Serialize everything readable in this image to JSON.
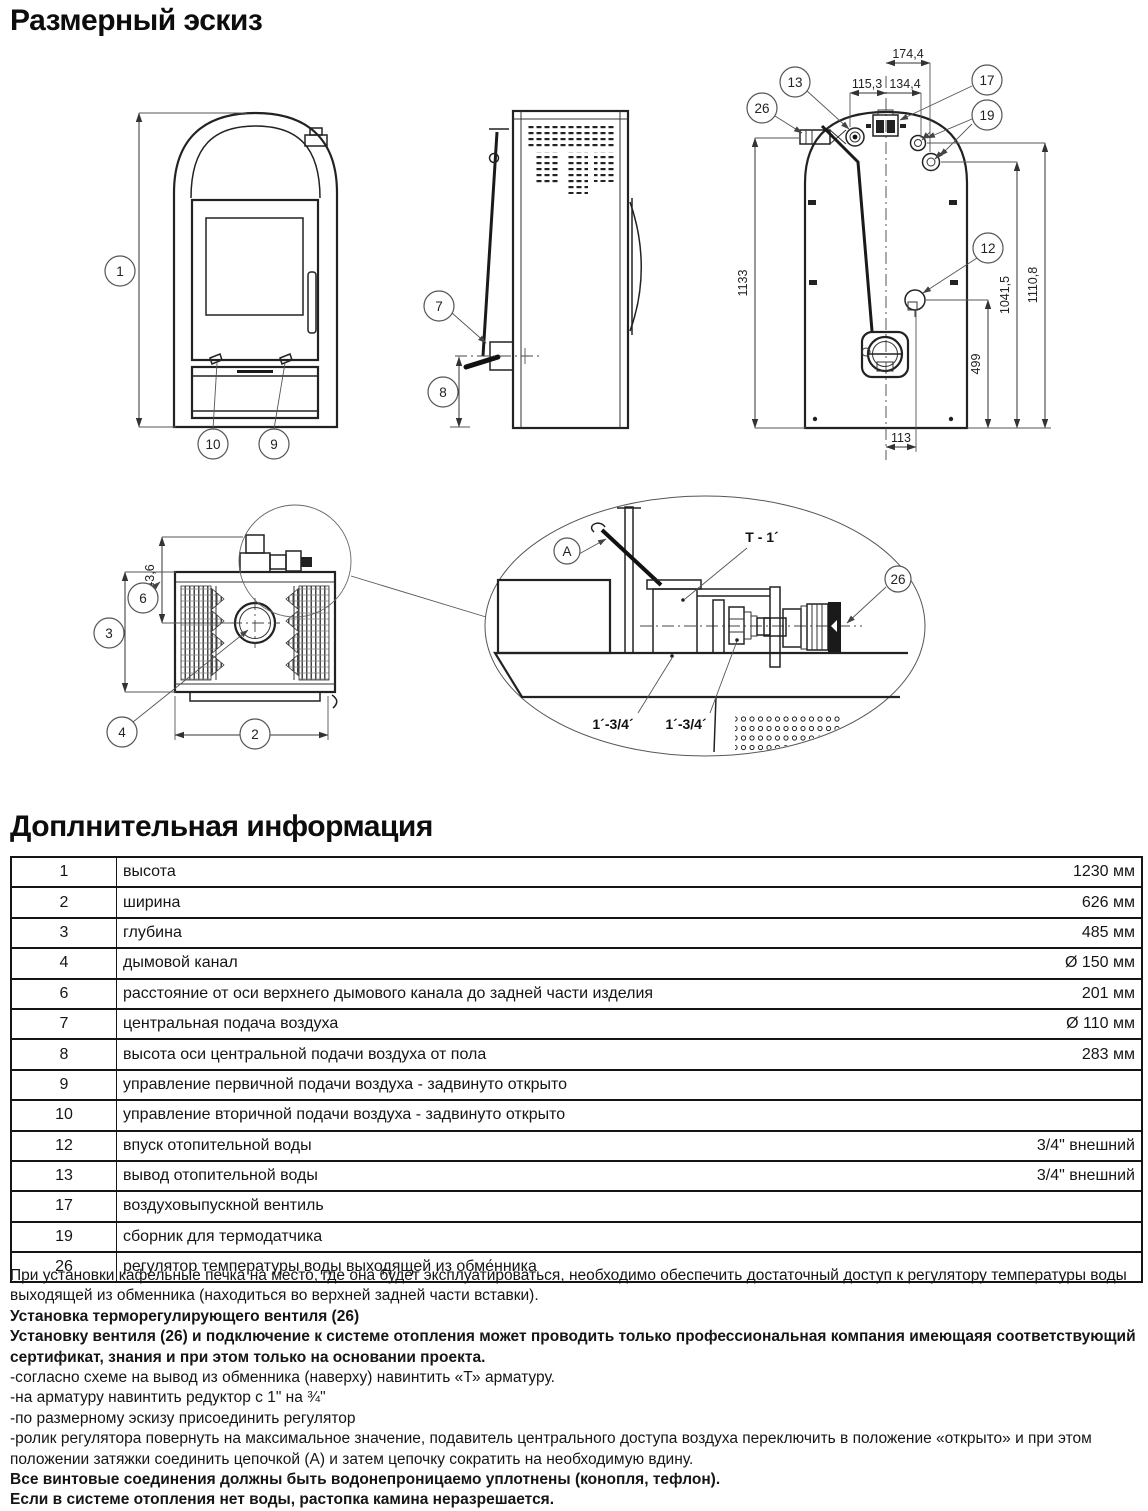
{
  "page": {
    "title": "Размерный эскиз"
  },
  "section": {
    "title": "Доплнительная информация"
  },
  "drawing": {
    "front": {
      "c1": "1",
      "c10": "10",
      "c9": "9"
    },
    "side": {
      "c7": "7",
      "c8": "8"
    },
    "rear": {
      "c13": "13",
      "c26": "26",
      "c17": "17",
      "c19": "19",
      "c12": "12",
      "d_top": "174,4",
      "d_left": "115,3",
      "d_right": "134,4",
      "d_h1": "1133",
      "d_h2": "1041,5",
      "d_h3": "1110,8",
      "d_499": "499",
      "d_113": "113"
    },
    "top": {
      "c6": "6",
      "c3": "3",
      "c4": "4",
      "c2": "2",
      "d_143": "143,6"
    },
    "detail": {
      "cA": "A",
      "t1": "T - 1´",
      "c26": "26",
      "th1": "1´-3/4´",
      "th2": "1´-3/4´"
    }
  },
  "table": {
    "rows": [
      {
        "num": "1",
        "label": "высота",
        "value": "1230 мм"
      },
      {
        "num": "2",
        "label": "ширина",
        "value": "626 мм"
      },
      {
        "num": "3",
        "label": "глубина",
        "value": "485 мм"
      },
      {
        "num": "4",
        "label": "дымовой канал",
        "value": "Ø 150 мм"
      },
      {
        "num": "6",
        "label": "расстояние от оси верхнего дымового канала до задней части изделия",
        "value": "201 мм"
      },
      {
        "num": "7",
        "label": "центральная подача воздуха",
        "value": "Ø 110 мм"
      },
      {
        "num": "8",
        "label": "высота оси центральной подачи воздуха от пола",
        "value": "283 мм"
      },
      {
        "num": "9",
        "label": "управление первичной подачи воздуха - задвинуто открыто",
        "value": ""
      },
      {
        "num": "10",
        "label": "управление вторичной подачи воздуха - задвинуто открыто",
        "value": ""
      },
      {
        "num": "12",
        "label": "впуск отопительной воды",
        "value": "3/4\" внешний"
      },
      {
        "num": "13",
        "label": "вывод отопительной воды",
        "value": "3/4\" внешний"
      },
      {
        "num": "17",
        "label": "воздуховыпускной вентиль",
        "value": ""
      },
      {
        "num": "19",
        "label": "сборник для термодатчика",
        "value": ""
      },
      {
        "num": "26",
        "label": "регулятор температуры воды выходящей из обме́нника",
        "value": ""
      }
    ]
  },
  "notes": [
    {
      "bold": false,
      "text": "При установки кафельные печка на место, где она будет эксплуатироваться, необходимо обеспечить достаточный доступ к регулятору температуры воды выходящей из обменника (находиться во верхней задней части вставки)."
    },
    {
      "bold": true,
      "text": "Установка терморегулирующего вентиля (26)"
    },
    {
      "bold": true,
      "text": "Установку вентиля (26) и подключение к системе отопления может проводить только профессиональная компания имеющаяя соответствующий сертификат, знания и при этом только на основании проекта."
    },
    {
      "bold": false,
      "text": "-согласно схеме на вывод из обменника (наверху) навинтить «Т» арматуру."
    },
    {
      "bold": false,
      "text": "-на арматуру навинтить редуктор с 1\" на ¾\""
    },
    {
      "bold": false,
      "text": "-по размерному эскизу присоединить регулятор"
    },
    {
      "bold": false,
      "text": "-ролик регулятора повернуть на максимальное значение, подавитель центрального доступа воздуха переключить в положение «открыто» и при этом положении затяжки соединить цепочкой (А) и затем цепочку сократить на необходимую вдину."
    },
    {
      "bold": true,
      "text": "Все винтовые соединения должны быть водонепроницаемо уплотнены (конопля, тефлон)."
    },
    {
      "bold": true,
      "text": "Если в системе отопления нет воды, растопка камина неразрешается."
    }
  ]
}
